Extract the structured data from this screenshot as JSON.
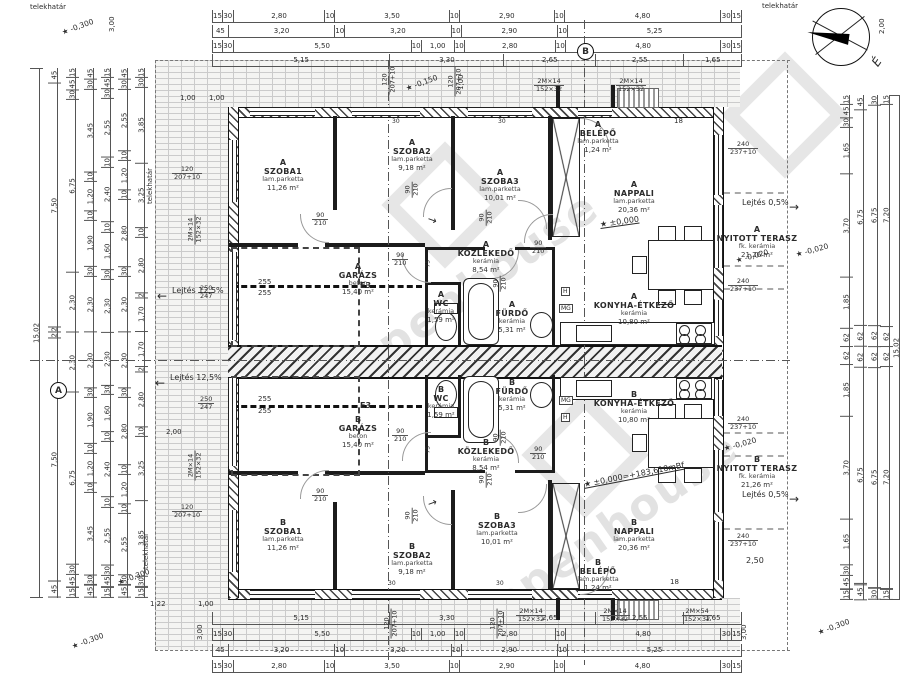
{
  "watermark": {
    "text": "openhouse"
  },
  "compass": {
    "label": "É"
  },
  "rooms": [
    {
      "u": "A",
      "n": "SZOBA1",
      "m": "lam.parketta",
      "a": "11,26 m²",
      "x": 283,
      "y": 158
    },
    {
      "u": "A",
      "n": "SZOBA2",
      "m": "lam.parketta",
      "a": "9,18 m²",
      "x": 412,
      "y": 138
    },
    {
      "u": "A",
      "n": "SZOBA3",
      "m": "lam.parketta",
      "a": "10,01 m²",
      "x": 500,
      "y": 168
    },
    {
      "u": "A",
      "n": "BELÉPŐ",
      "m": "lam.parketta",
      "a": "1,24 m²",
      "x": 598,
      "y": 120
    },
    {
      "u": "A",
      "n": "NAPPALI",
      "m": "lam.parketta",
      "a": "20,36 m²",
      "x": 634,
      "y": 180
    },
    {
      "u": "A",
      "n": "GARÁZS",
      "m": "beton",
      "a": "15,40 m²",
      "x": 358,
      "y": 262
    },
    {
      "u": "A",
      "n": "KÖZLEKEDŐ",
      "m": "kerámia",
      "a": "8,54 m²",
      "x": 486,
      "y": 240
    },
    {
      "u": "A",
      "n": "WC",
      "m": "kerámia",
      "a": "1,59 m²",
      "x": 441,
      "y": 290
    },
    {
      "u": "A",
      "n": "FÜRDŐ",
      "m": "kerámia",
      "a": "5,31 m²",
      "x": 512,
      "y": 300
    },
    {
      "u": "A",
      "n": "KONYHA-ÉTKEZŐ",
      "m": "kerámia",
      "a": "10,80 m²",
      "x": 634,
      "y": 292
    },
    {
      "u": "A",
      "n": "NYITOTT TERASZ",
      "m": "fk. kerámia",
      "a": "21,26 m²",
      "x": 757,
      "y": 225
    },
    {
      "u": "B",
      "n": "KONYHA-ÉTKEZŐ",
      "m": "kerámia",
      "a": "10,80 m²",
      "x": 634,
      "y": 390
    },
    {
      "u": "B",
      "n": "FÜRDŐ",
      "m": "kerámia",
      "a": "5,31 m²",
      "x": 512,
      "y": 378
    },
    {
      "u": "B",
      "n": "WC",
      "m": "kerámia",
      "a": "1,59 m²",
      "x": 441,
      "y": 385
    },
    {
      "u": "B",
      "n": "GARÁZS",
      "m": "beton",
      "a": "15,40 m²",
      "x": 358,
      "y": 415
    },
    {
      "u": "B",
      "n": "KÖZLEKEDŐ",
      "m": "kerámia",
      "a": "8,54 m²",
      "x": 486,
      "y": 438
    },
    {
      "u": "B",
      "n": "SZOBA1",
      "m": "lam.parketta",
      "a": "11,26 m²",
      "x": 283,
      "y": 518
    },
    {
      "u": "B",
      "n": "SZOBA2",
      "m": "lam.parketta",
      "a": "9,18 m²",
      "x": 412,
      "y": 542
    },
    {
      "u": "B",
      "n": "SZOBA3",
      "m": "lam.parketta",
      "a": "10,01 m²",
      "x": 497,
      "y": 512
    },
    {
      "u": "B",
      "n": "BELÉPŐ",
      "m": "lam.parketta",
      "a": "1,24 m²",
      "x": 598,
      "y": 558
    },
    {
      "u": "B",
      "n": "NAPPALI",
      "m": "lam.parketta",
      "a": "20,36 m²",
      "x": 634,
      "y": 518
    },
    {
      "u": "B",
      "n": "NYITOTT TERASZ",
      "m": "fk. kerámia",
      "a": "21,26 m²",
      "x": 757,
      "y": 455
    }
  ],
  "labels": [
    {
      "t": "telekhatár",
      "x": 30,
      "y": 3,
      "fs": 7
    },
    {
      "t": "telekhatár",
      "x": 762,
      "y": 2,
      "fs": 7
    },
    {
      "t": "telekhatár",
      "x": 150,
      "y": 200,
      "r": -90,
      "fs": 7
    },
    {
      "t": "telekhatár",
      "x": 146,
      "y": 565,
      "r": -90,
      "fs": 7
    },
    {
      "t": "Lejtés 12,5%",
      "x": 172,
      "y": 286,
      "fs": 8
    },
    {
      "t": "←",
      "x": 157,
      "y": 289,
      "fs": 12
    },
    {
      "t": "Lejtés 12,5%",
      "x": 170,
      "y": 373,
      "fs": 8
    },
    {
      "t": "←",
      "x": 155,
      "y": 376,
      "fs": 12
    },
    {
      "t": "Lejtés 0,5%",
      "x": 742,
      "y": 198,
      "fs": 8
    },
    {
      "t": "→",
      "x": 789,
      "y": 200,
      "fs": 12
    },
    {
      "t": "Lejtés 0,5%",
      "x": 742,
      "y": 490,
      "fs": 8
    },
    {
      "t": "→",
      "x": 789,
      "y": 492,
      "fs": 12
    },
    {
      "t": "★ -0,300",
      "x": 62,
      "y": 28,
      "r": -20,
      "fs": 7.5
    },
    {
      "t": "★ -0,300",
      "x": 118,
      "y": 578,
      "r": -20,
      "fs": 7.5
    },
    {
      "t": "★ -0,300",
      "x": 72,
      "y": 642,
      "r": -20,
      "fs": 7.5
    },
    {
      "t": "★ -0,300",
      "x": 818,
      "y": 628,
      "r": -20,
      "fs": 7.5
    },
    {
      "t": "★ -0,150",
      "x": 406,
      "y": 84,
      "r": -20,
      "fs": 7.5
    },
    {
      "t": "★ -0,020",
      "x": 736,
      "y": 256,
      "r": -15,
      "fs": 7.5
    },
    {
      "t": "★ -0,020",
      "x": 796,
      "y": 250,
      "r": -15,
      "fs": 7.5
    },
    {
      "t": "★ -0,020",
      "x": 724,
      "y": 444,
      "r": -15,
      "fs": 7.5
    },
    {
      "t": "★ ±0,000",
      "x": 600,
      "y": 220,
      "r": -8,
      "fs": 8,
      "c": "ul"
    },
    {
      "t": "★ ±0,000=+183,610mBf",
      "x": 584,
      "y": 480,
      "r": -11,
      "fs": 8,
      "c": "ul"
    },
    {
      "t": "3,00",
      "x": 112,
      "y": 28,
      "r": -90,
      "fs": 7
    },
    {
      "t": "3,00",
      "x": 200,
      "y": 636,
      "r": -90,
      "fs": 7
    },
    {
      "t": "3,00",
      "x": 744,
      "y": 636,
      "r": -90,
      "fs": 7
    },
    {
      "t": "2,00",
      "x": 882,
      "y": 30,
      "r": -90,
      "fs": 7
    },
    {
      "t": "1,00",
      "x": 461,
      "y": 86,
      "r": -90,
      "fs": 7
    },
    {
      "t": "1,00",
      "x": 180,
      "y": 94,
      "fs": 7
    },
    {
      "t": "1,00",
      "x": 209,
      "y": 94,
      "fs": 7
    },
    {
      "t": "1,22",
      "x": 150,
      "y": 600,
      "fs": 7
    },
    {
      "t": "1,00",
      "x": 198,
      "y": 600,
      "fs": 7
    },
    {
      "t": "2,00",
      "x": 166,
      "y": 428,
      "fs": 7
    },
    {
      "t": "2,50",
      "x": 746,
      "y": 556,
      "fs": 8
    },
    {
      "t": "18",
      "x": 674,
      "y": 117,
      "fs": 7
    },
    {
      "t": "18",
      "x": 670,
      "y": 578,
      "fs": 7
    },
    {
      "t": "30",
      "x": 392,
      "y": 118,
      "fs": 6
    },
    {
      "t": "30",
      "x": 498,
      "y": 118,
      "fs": 6
    },
    {
      "t": "30",
      "x": 388,
      "y": 580,
      "fs": 6
    },
    {
      "t": "30",
      "x": 496,
      "y": 580,
      "fs": 6
    },
    {
      "t": "255",
      "x": 258,
      "y": 278,
      "fs": 7
    },
    {
      "t": "255",
      "x": 258,
      "y": 289,
      "fs": 7
    },
    {
      "t": "255",
      "x": 258,
      "y": 395,
      "fs": 7
    },
    {
      "t": "255",
      "x": 258,
      "y": 407,
      "fs": 7
    },
    {
      "t": "E3",
      "x": 360,
      "y": 281,
      "fs": 8,
      "c": "bold"
    },
    {
      "t": "E3",
      "x": 360,
      "y": 401,
      "fs": 8,
      "c": "bold"
    },
    {
      "t": "H",
      "x": 561,
      "y": 287,
      "fs": 6,
      "c": "box"
    },
    {
      "t": "MG",
      "x": 559,
      "y": 304,
      "fs": 6,
      "c": "box"
    },
    {
      "t": "MG",
      "x": 559,
      "y": 396,
      "fs": 6,
      "c": "box"
    },
    {
      "t": "H",
      "x": 561,
      "y": 413,
      "fs": 6,
      "c": "box"
    },
    {
      "t": "75",
      "x": 428,
      "y": 264,
      "r": -90,
      "fs": 6
    },
    {
      "t": "75",
      "x": 428,
      "y": 450,
      "r": -90,
      "fs": 6
    },
    {
      "t": "→",
      "x": 428,
      "y": 212,
      "r": 20,
      "fs": 11
    },
    {
      "t": "→",
      "x": 428,
      "y": 498,
      "r": -20,
      "fs": 11
    }
  ],
  "wtags": [
    {
      "t1": "90",
      "t2": "210",
      "x": 312,
      "y": 212
    },
    {
      "t1": "90",
      "t2": "210",
      "x": 392,
      "y": 252
    },
    {
      "t1": "90",
      "t2": "210",
      "x": 530,
      "y": 240
    },
    {
      "t1": "90",
      "t2": "210",
      "x": 404,
      "y": 182,
      "r": -90
    },
    {
      "t1": "90",
      "t2": "210",
      "x": 478,
      "y": 210,
      "r": -90
    },
    {
      "t1": "90",
      "t2": "210",
      "x": 492,
      "y": 276,
      "r": -90
    },
    {
      "t1": "90",
      "t2": "210",
      "x": 312,
      "y": 488
    },
    {
      "t1": "90",
      "t2": "210",
      "x": 392,
      "y": 428
    },
    {
      "t1": "90",
      "t2": "210",
      "x": 530,
      "y": 446
    },
    {
      "t1": "90",
      "t2": "210",
      "x": 404,
      "y": 508,
      "r": -90
    },
    {
      "t1": "90",
      "t2": "210",
      "x": 478,
      "y": 472,
      "r": -90
    },
    {
      "t1": "90",
      "t2": "210",
      "x": 492,
      "y": 430,
      "r": -90
    },
    {
      "t1": "120",
      "t2": "207+10",
      "x": 172,
      "y": 166
    },
    {
      "t1": "120",
      "t2": "207+10",
      "x": 172,
      "y": 504
    },
    {
      "t1": "120",
      "t2": "207+10",
      "x": 374,
      "y": 72,
      "r": -90
    },
    {
      "t1": "120",
      "t2": "207+10",
      "x": 440,
      "y": 74,
      "r": -90
    },
    {
      "t1": "120",
      "t2": "207+10",
      "x": 376,
      "y": 616,
      "r": -90
    },
    {
      "t1": "120",
      "t2": "207+10",
      "x": 482,
      "y": 616,
      "r": -90
    },
    {
      "t1": "240",
      "t2": "237+10",
      "x": 728,
      "y": 141
    },
    {
      "t1": "240",
      "t2": "237+10",
      "x": 728,
      "y": 278
    },
    {
      "t1": "240",
      "t2": "237+10",
      "x": 728,
      "y": 416
    },
    {
      "t1": "240",
      "t2": "237+10",
      "x": 728,
      "y": 533
    },
    {
      "t1": "2M×14",
      "t2": "152×32",
      "x": 534,
      "y": 78
    },
    {
      "t1": "2M×14",
      "t2": "152×32",
      "x": 616,
      "y": 78
    },
    {
      "t1": "2M×14",
      "t2": "152×32",
      "x": 516,
      "y": 608
    },
    {
      "t1": "2M×14",
      "t2": "152×32",
      "x": 600,
      "y": 608
    },
    {
      "t1": "2M×54",
      "t2": "152×32",
      "x": 682,
      "y": 608
    },
    {
      "t1": "2M×14",
      "t2": "152×32",
      "x": 180,
      "y": 222,
      "r": -90
    },
    {
      "t1": "2M×14",
      "t2": "152×32",
      "x": 180,
      "y": 458,
      "r": -90
    },
    {
      "t1": "250",
      "t2": "247",
      "x": 198,
      "y": 285
    },
    {
      "t1": "250",
      "t2": "247",
      "x": 198,
      "y": 396
    }
  ],
  "markers": [
    {
      "t": "B",
      "x": 577,
      "y": 43
    },
    {
      "t": "A",
      "x": 50,
      "y": 382
    }
  ],
  "dims": {
    "top1": [
      "15",
      "30",
      "2,80",
      "10",
      "3,50",
      "10",
      "2,90",
      "10",
      "4,80",
      "30",
      "15"
    ],
    "top2": [
      "45",
      "3,20",
      "10",
      "3,20",
      "10",
      "2,90",
      "10",
      "5,25"
    ],
    "top3": [
      "15",
      "30",
      "5,50",
      "10",
      "1,00",
      "10",
      "2,80",
      "10",
      "4,80",
      "30",
      "15"
    ],
    "top4": [
      "5,15",
      "3,30",
      "2,65",
      "2,55",
      "1,65"
    ],
    "bottom1": [
      "5,15",
      "3,30",
      "2,65",
      "2,55",
      "1,65"
    ],
    "bottom2": [
      "15",
      "30",
      "5,50",
      "10",
      "1,00",
      "10",
      "2,80",
      "10",
      "4,80",
      "30",
      "15"
    ],
    "bottom3": [
      "45",
      "3,20",
      "10",
      "3,20",
      "10",
      "2,90",
      "10",
      "5,25"
    ],
    "bottom4": [
      "15",
      "30",
      "2,80",
      "10",
      "3,50",
      "10",
      "2,90",
      "10",
      "4,80",
      "30",
      "15"
    ],
    "left1": [
      "15,02"
    ],
    "left2": [
      "45",
      "7,50",
      "2",
      "2",
      "7,50",
      "45"
    ],
    "left3": [
      "15",
      "45",
      "30",
      "6,75",
      "2,30",
      "2,30",
      "6,75",
      "30",
      "45",
      "15"
    ],
    "left4": [
      "45",
      "30",
      "3,45",
      "10",
      "1,20",
      "10",
      "1,90",
      "30",
      "2,30",
      "2,30",
      "30",
      "1,90",
      "10",
      "1,20",
      "10",
      "3,45",
      "30",
      "45"
    ],
    "left5": [
      "15",
      "45",
      "30",
      "2,55",
      "10",
      "2,40",
      "10",
      "1,60",
      "30",
      "2,30",
      "2,30",
      "30",
      "1,60",
      "10",
      "2,40",
      "10",
      "2,55",
      "30",
      "45",
      "15"
    ],
    "left6": [
      "45",
      "30",
      "2,55",
      "10",
      "1,20",
      "10",
      "2,80",
      "30",
      "2,30",
      "2,30",
      "30",
      "2,80",
      "10",
      "1,20",
      "10",
      "2,55",
      "30",
      "45"
    ],
    "left7": [
      "15",
      "30",
      "3,85",
      "3,25",
      "10",
      "2,80",
      "2",
      "1,70",
      "1,70",
      "2",
      "2,80",
      "10",
      "3,25",
      "3,85",
      "30",
      "15"
    ],
    "right1": [
      "15",
      "45",
      "30",
      "1,65",
      "3,70",
      "1,85",
      "62",
      "62",
      "1,85",
      "3,70",
      "1,65",
      "30",
      "45",
      "15"
    ],
    "right2": [
      "45",
      "6,75",
      "62",
      "62",
      "6,75",
      "45"
    ],
    "right3": [
      "30",
      "6,75",
      "62",
      "62",
      "6,75",
      "30"
    ],
    "right4": [
      "15",
      "7,20",
      "62",
      "62",
      "7,20",
      "15"
    ],
    "right5": [
      "15,02"
    ]
  }
}
